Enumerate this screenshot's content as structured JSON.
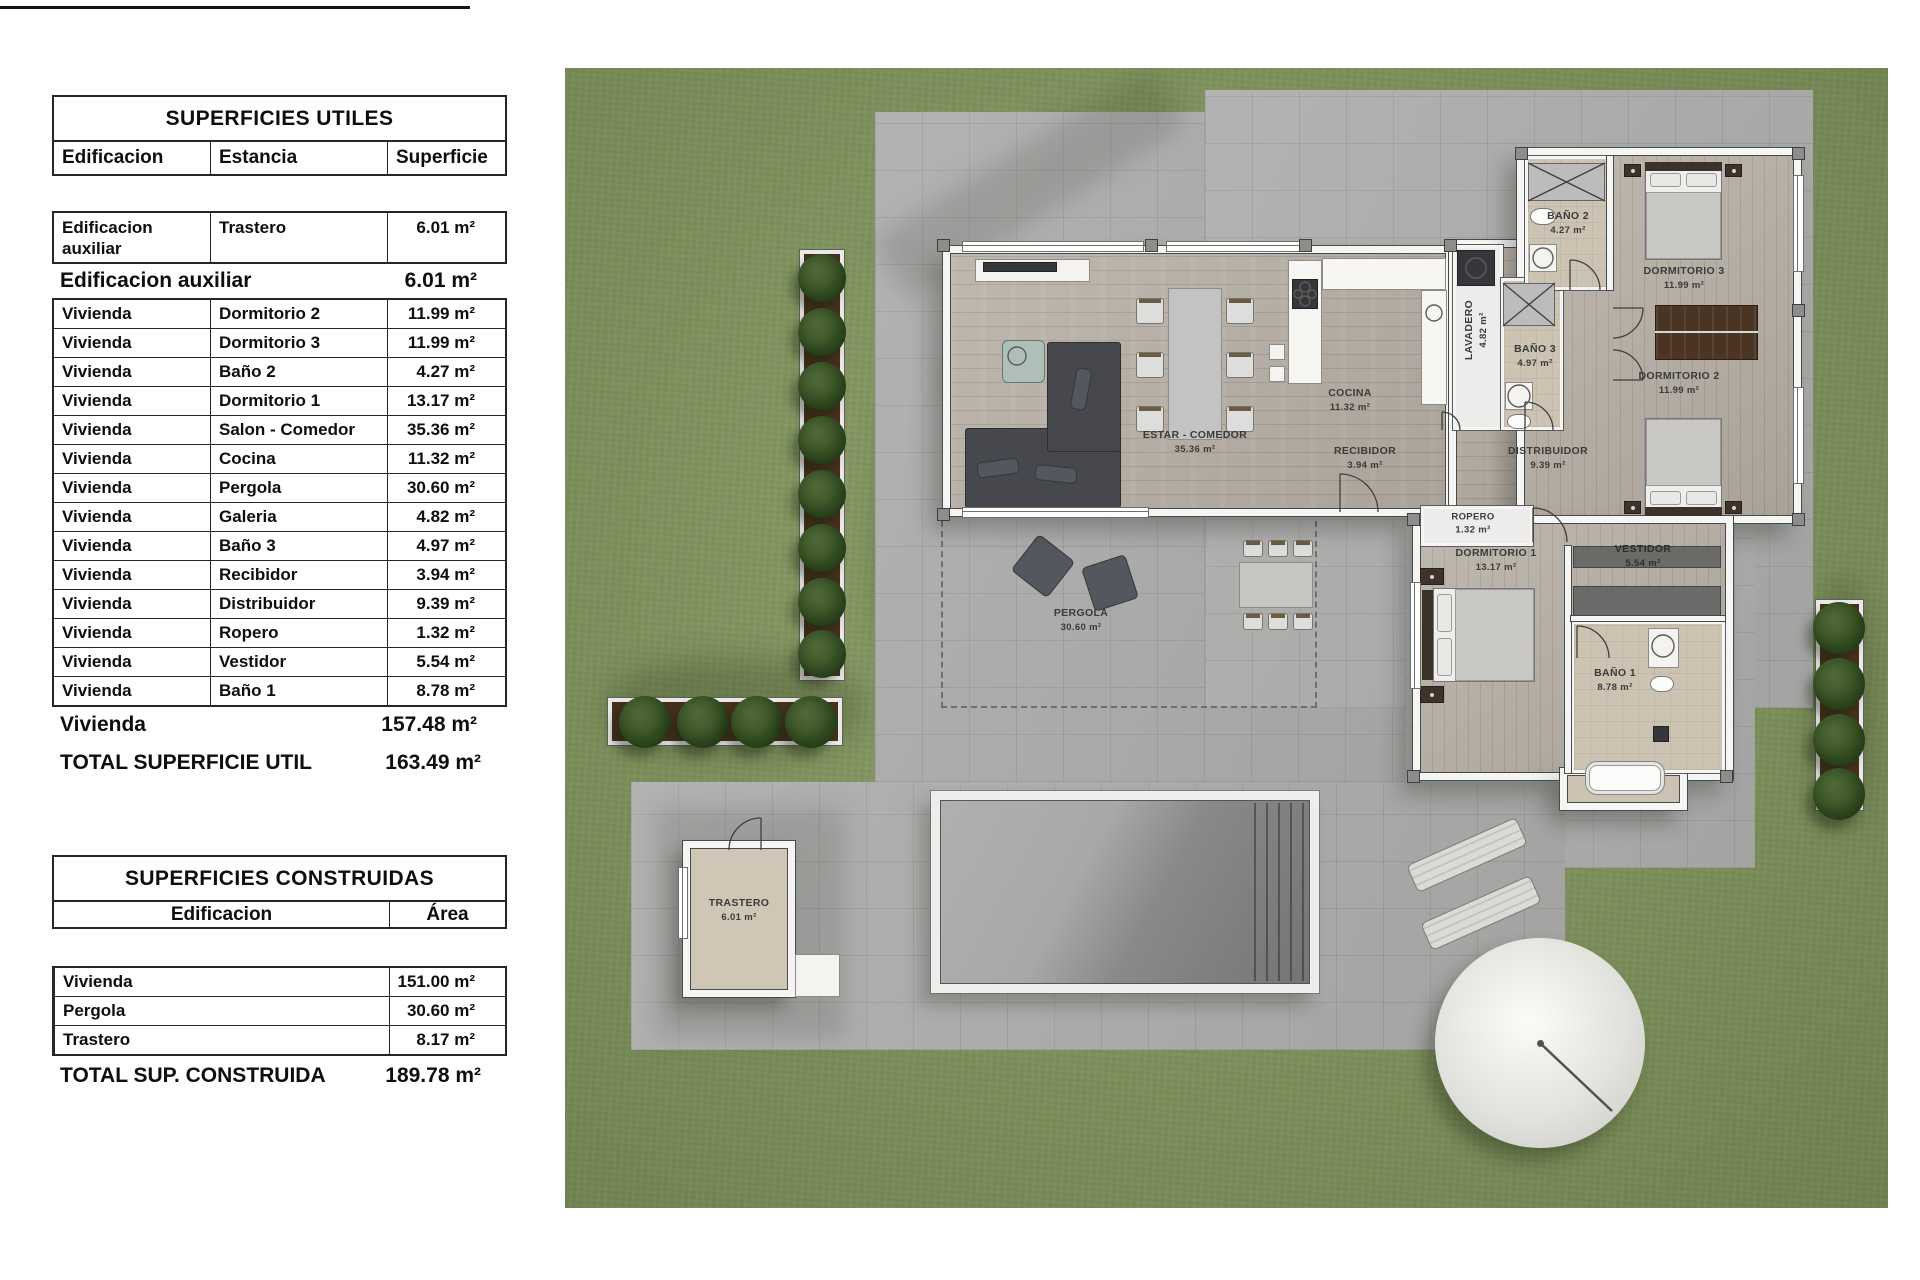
{
  "tables": {
    "utiles": {
      "title": "SUPERFICIES UTILES",
      "columns": [
        "Edificacion",
        "Estancia",
        "Superficie"
      ],
      "aux_row": {
        "edificacion_l1": "Edificacion",
        "edificacion_l2": "auxiliar",
        "estancia": "Trastero",
        "superficie": "6.01 m²"
      },
      "aux_total": {
        "label": "Edificacion auxiliar",
        "value": "6.01 m²"
      },
      "rows": [
        [
          "Vivienda",
          "Dormitorio 2",
          "11.99 m²"
        ],
        [
          "Vivienda",
          "Dormitorio 3",
          "11.99 m²"
        ],
        [
          "Vivienda",
          "Baño 2",
          "4.27 m²"
        ],
        [
          "Vivienda",
          "Dormitorio 1",
          "13.17 m²"
        ],
        [
          "Vivienda",
          "Salon - Comedor",
          "35.36 m²"
        ],
        [
          "Vivienda",
          "Cocina",
          "11.32 m²"
        ],
        [
          "Vivienda",
          "Pergola",
          "30.60 m²"
        ],
        [
          "Vivienda",
          "Galeria",
          "4.82 m²"
        ],
        [
          "Vivienda",
          "Baño 3",
          "4.97 m²"
        ],
        [
          "Vivienda",
          "Recibidor",
          "3.94 m²"
        ],
        [
          "Vivienda",
          "Distribuidor",
          "9.39 m²"
        ],
        [
          "Vivienda",
          "Ropero",
          "1.32 m²"
        ],
        [
          "Vivienda",
          "Vestidor",
          "5.54 m²"
        ],
        [
          "Vivienda",
          "Baño 1",
          "8.78 m²"
        ]
      ],
      "vivienda_total": {
        "label": "Vivienda",
        "value": "157.48 m²"
      },
      "total": {
        "label": "TOTAL SUPERFICIE UTIL",
        "value": "163.49 m²"
      }
    },
    "construidas": {
      "title": "SUPERFICIES CONSTRUIDAS",
      "columns": [
        "Edificacion",
        "Área"
      ],
      "rows": [
        [
          "Vivienda",
          "151.00 m²"
        ],
        [
          "Pergola",
          "30.60 m²"
        ],
        [
          "Trastero",
          "8.17 m²"
        ]
      ],
      "total": {
        "label": "TOTAL SUP. CONSTRUIDA",
        "value": "189.78 m²"
      }
    }
  },
  "plan": {
    "labels": [
      {
        "name": "ESTAR - COMEDOR",
        "area": "35.36 m²"
      },
      {
        "name": "COCINA",
        "area": "11.32 m²"
      },
      {
        "name": "LAVADERO",
        "area": "4.82 m²"
      },
      {
        "name": "BAÑO 3",
        "area": "4.97 m²"
      },
      {
        "name": "BAÑO 2",
        "area": "4.27 m²"
      },
      {
        "name": "DORMITORIO 3",
        "area": "11.99 m²"
      },
      {
        "name": "DORMITORIO 2",
        "area": "11.99 m²"
      },
      {
        "name": "RECIBIDOR",
        "area": "3.94 m²"
      },
      {
        "name": "DISTRIBUIDOR",
        "area": "9.39 m²"
      },
      {
        "name": "ROPERO",
        "area": "1.32 m²"
      },
      {
        "name": "DORMITORIO 1",
        "area": "13.17 m²"
      },
      {
        "name": "VESTIDOR",
        "area": "5.54 m²"
      },
      {
        "name": "BAÑO 1",
        "area": "8.78 m²"
      },
      {
        "name": "PERGOLA",
        "area": "30.60 m²"
      },
      {
        "name": "TRASTERO",
        "area": "6.01 m²"
      }
    ],
    "colors": {
      "grass": "#7d9159",
      "paving": "#adadac",
      "wood": "#b8b0a5",
      "bath_floor": "#cdc3b2",
      "wall": "#f5f5f3"
    }
  }
}
